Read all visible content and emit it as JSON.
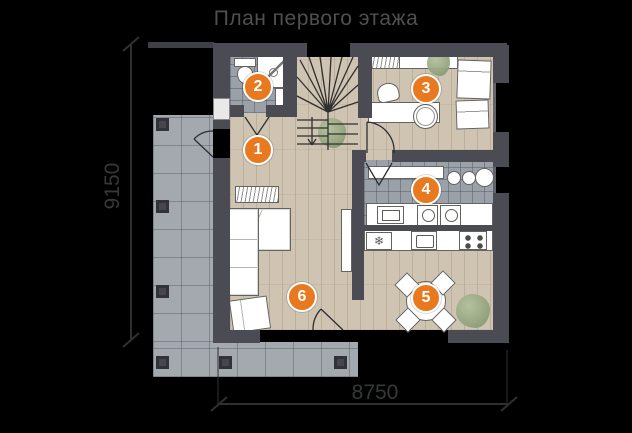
{
  "title": "План первого этажа",
  "dimensions": {
    "left_vertical": "9150",
    "bottom_horizontal": "8750"
  },
  "room_markers": [
    {
      "number": "1"
    },
    {
      "number": "2"
    },
    {
      "number": "3"
    },
    {
      "number": "4"
    },
    {
      "number": "5"
    },
    {
      "number": "6"
    }
  ],
  "icons": {
    "fridge_snowflake": "❄"
  },
  "colors": {
    "background": "#000000",
    "marker_orange": "#e8791f",
    "wall": "#4b4c53",
    "wood_floor": "#cfc4b1",
    "tile_floor": "#9aa1a9",
    "terrace_tile": "#a4a9b0",
    "title_text": "#4f4f4f",
    "dimension_text": "#36383a",
    "plant_green": "#93a47e",
    "furniture": "#ffffff"
  }
}
